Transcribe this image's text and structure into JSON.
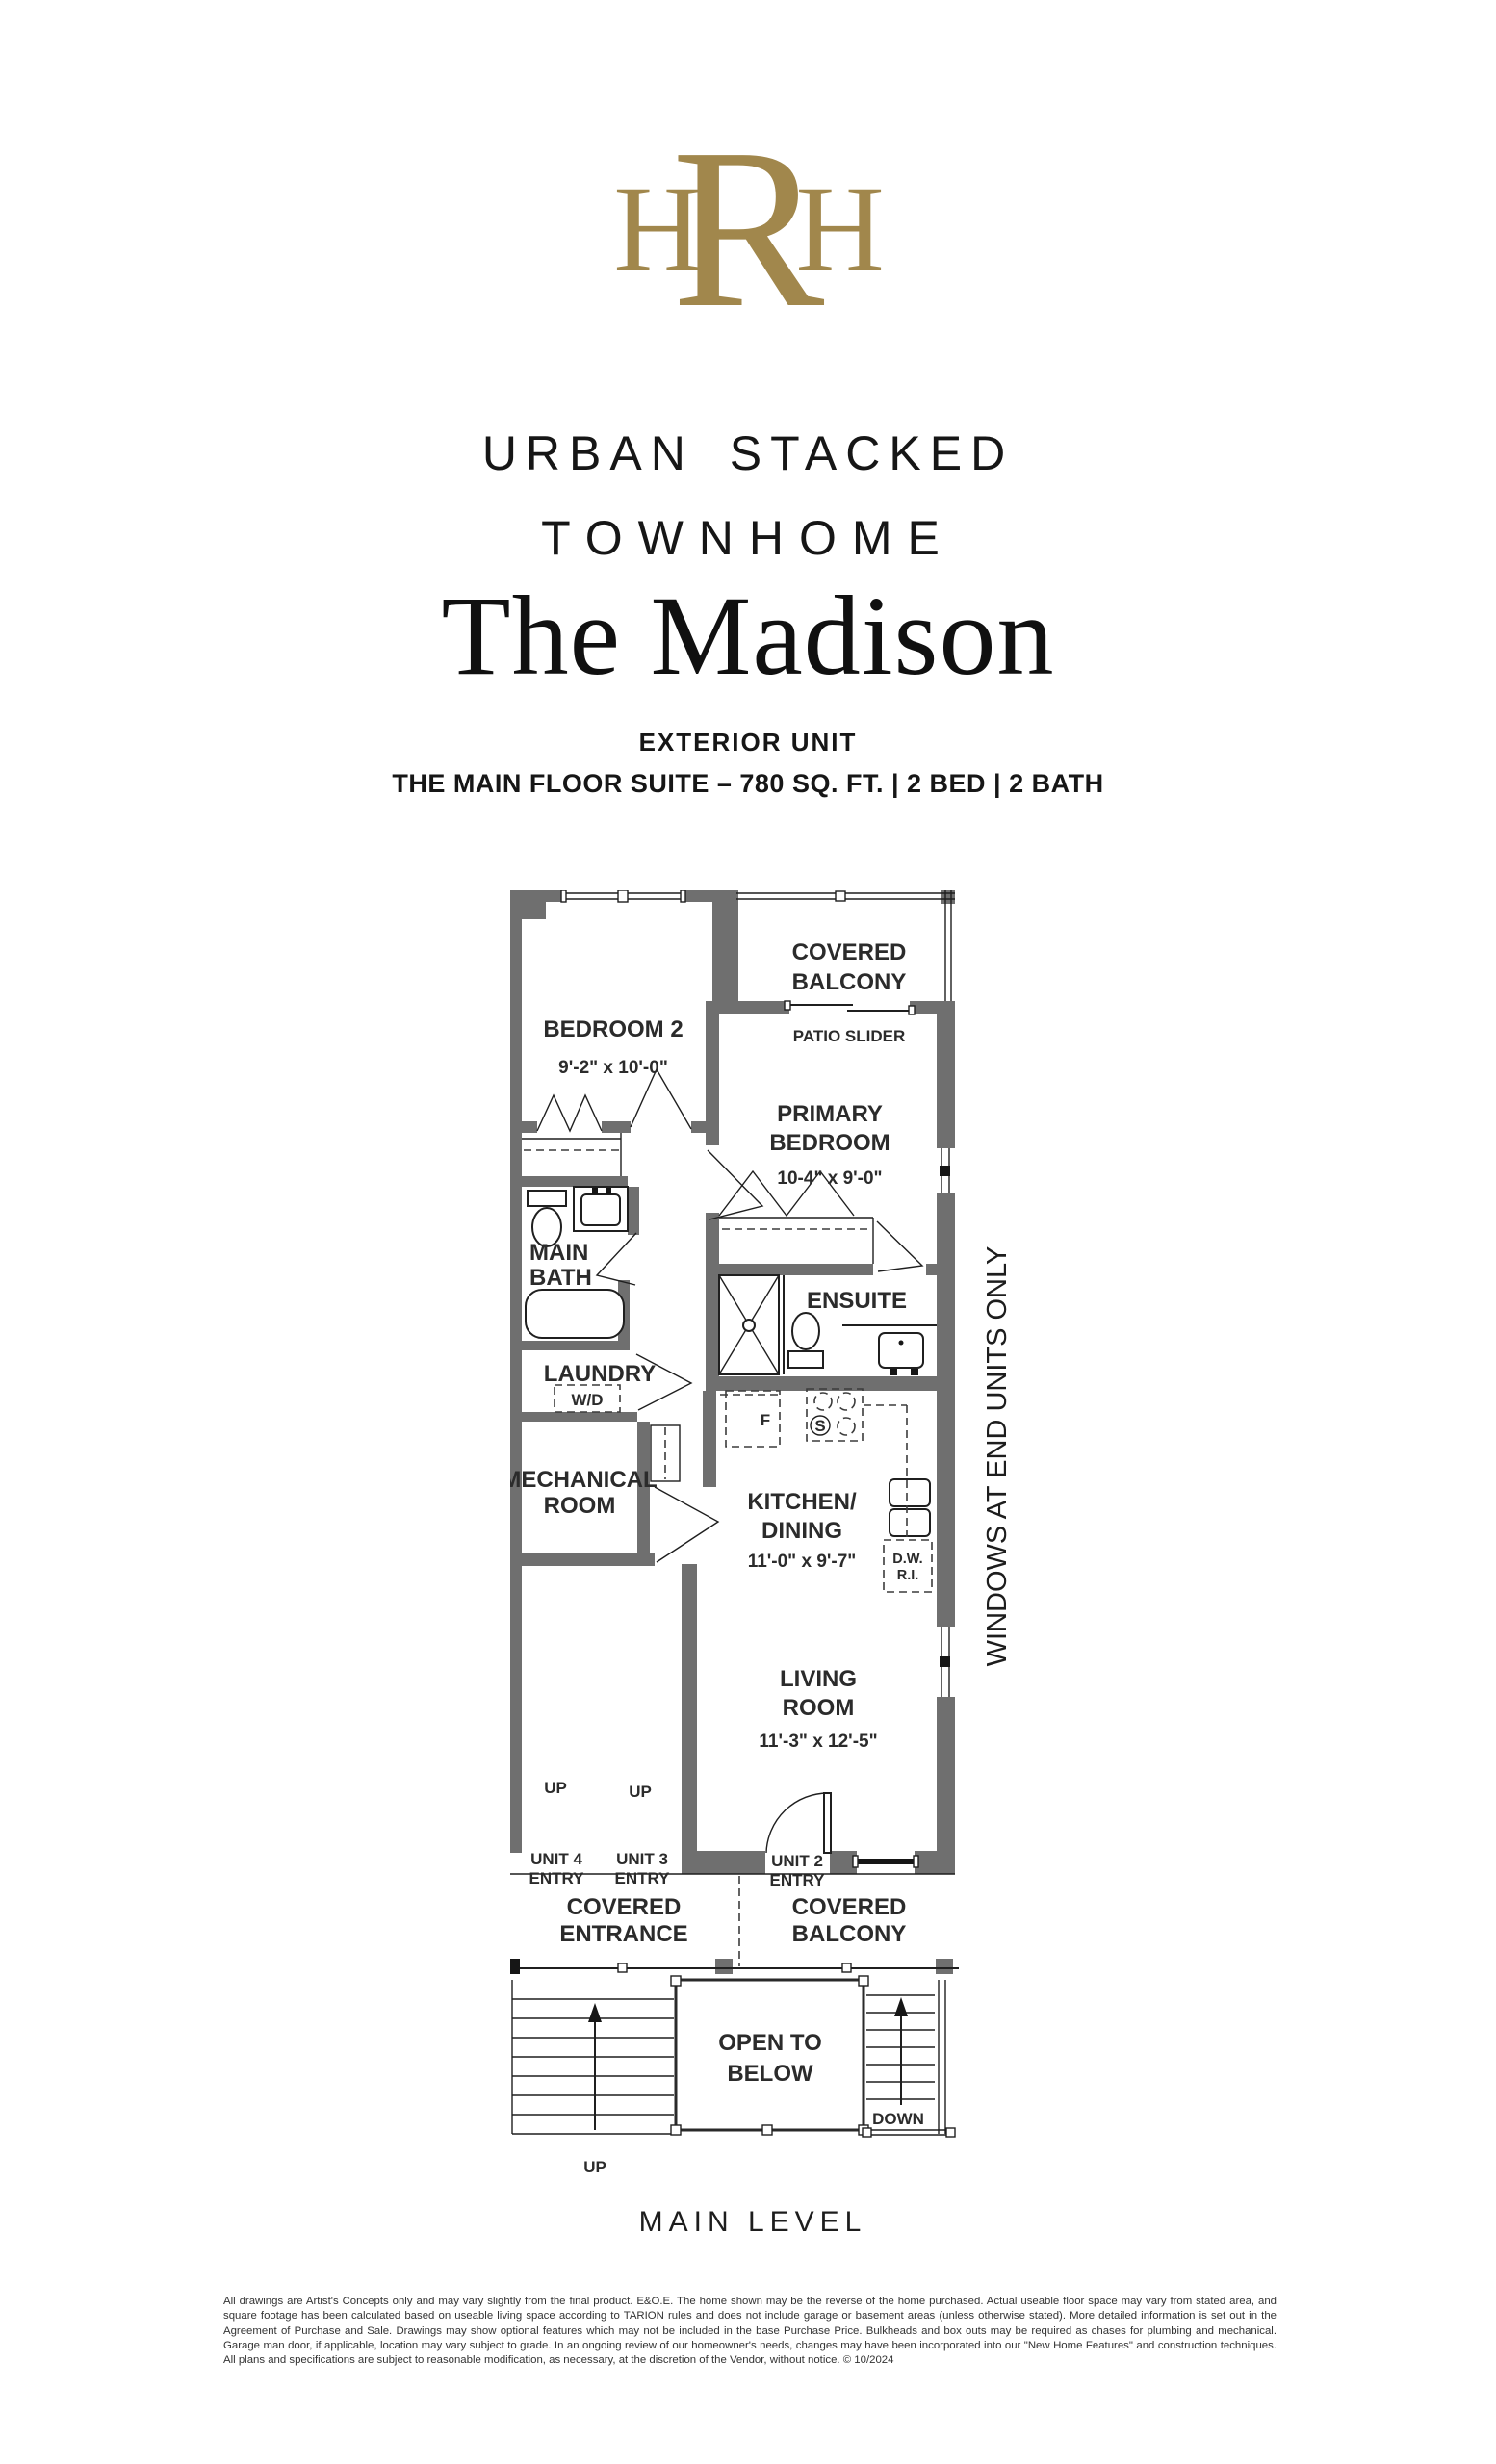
{
  "brand": {
    "monogram_left": "H",
    "monogram_center": "R",
    "monogram_right": "H",
    "gold": "#a1874c"
  },
  "header": {
    "line1": "URBAN STACKED",
    "line2": "TOWNHOME",
    "title": "The Madison",
    "subtitle": "EXTERIOR UNIT",
    "spec": "THE MAIN FLOOR SUITE – 780 SQ. FT. | 2 BED | 2 BATH"
  },
  "plan": {
    "side_note": "WINDOWS AT END UNITS ONLY",
    "caption": "MAIN LEVEL",
    "rooms": {
      "bedroom2": {
        "name": "BEDROOM 2",
        "dims": "9'-2\" x 10'-0\""
      },
      "balcony_top": {
        "l1": "COVERED",
        "l2": "BALCONY"
      },
      "patio_slider": "PATIO SLIDER",
      "primary": {
        "l1": "PRIMARY",
        "l2": "BEDROOM",
        "dims": "10-4\" x 9'-0\""
      },
      "main_bath": {
        "l1": "MAIN",
        "l2": "BATH"
      },
      "ensuite": "ENSUITE",
      "laundry": {
        "name": "LAUNDRY",
        "wd": "W/D"
      },
      "mechanical": {
        "l1": "MECHANICAL",
        "l2": "ROOM"
      },
      "kitchen": {
        "l1": "KITCHEN/",
        "l2": "DINING",
        "dims": "11'-0\" x 9'-7\""
      },
      "living": {
        "l1": "LIVING",
        "l2": "ROOM",
        "dims": "11'-3\" x 12'-5\""
      },
      "entrance": {
        "l1": "COVERED",
        "l2": "ENTRANCE"
      },
      "balcony_bottom": {
        "l1": "COVERED",
        "l2": "BALCONY"
      },
      "open_below": {
        "l1": "OPEN TO",
        "l2": "BELOW"
      }
    },
    "markers": {
      "up_hall_1": "UP",
      "up_hall_2": "UP",
      "up_stairs": "UP",
      "down": "DOWN",
      "unit4_l1": "UNIT 4",
      "unit4_l2": "ENTRY",
      "unit3_l1": "UNIT 3",
      "unit3_l2": "ENTRY",
      "unit2_l1": "UNIT 2",
      "unit2_l2": "ENTRY",
      "fridge": "F",
      "stove": "S",
      "dw_l1": "D.W.",
      "dw_l2": "R.I."
    }
  },
  "footer": {
    "disclaimer": "All drawings are Artist's Concepts only and may vary slightly from the final product. E&O.E. The home shown may be the reverse of the home purchased. Actual useable floor space may vary from stated area, and square footage has been calculated based on useable living space according to TARION rules and does not include garage or basement areas (unless otherwise stated). More detailed information is set out in the Agreement of Purchase and Sale. Drawings may show optional features which may not be included in the base Purchase Price. Bulkheads and box outs may be required as chases for plumbing and mechanical. Garage man door, if applicable, location may vary subject to grade. In an ongoing review of our homeowner's needs, changes may have been incorporated into our \"New Home Features\" and construction techniques. All plans and specifications are subject to reasonable modification, as necessary, at the discretion of the Vendor, without notice. © 10/2024"
  },
  "colors": {
    "wall": "#6f6f6f",
    "line": "#1f1f1f",
    "gold": "#a1874c"
  }
}
